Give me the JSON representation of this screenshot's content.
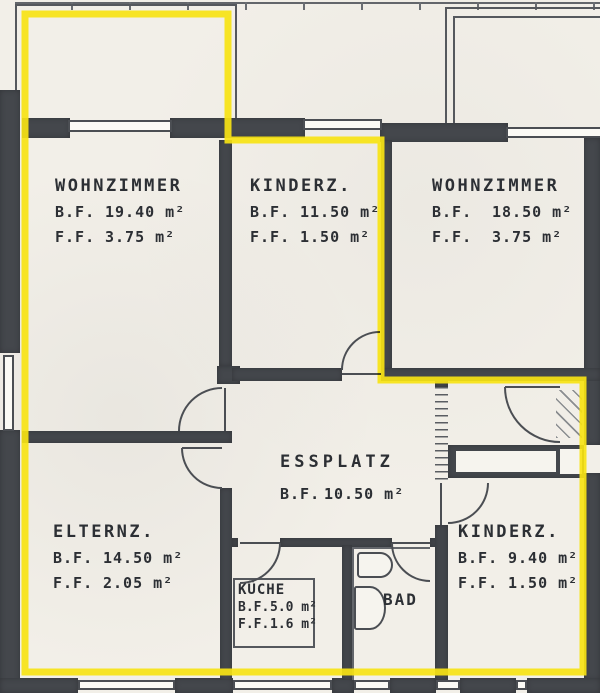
{
  "document_type": "apartment floor plan (scanned)",
  "colors": {
    "highlight_marker": "#f8e313",
    "wall": "#44474c",
    "paper": "#f2efe8",
    "line": "#4b4e53",
    "text": "#2c2f34"
  },
  "rooms": {
    "wohnzimmer_left": {
      "name": "WOHNZIMMER",
      "areas": [
        {
          "k": "B.F.",
          "v": "19.40 m²"
        },
        {
          "k": "F.F.",
          "v": "3.75 m²"
        }
      ]
    },
    "kinderz_mid": {
      "name": "KINDERZ.",
      "areas": [
        {
          "k": "B.F.",
          "v": "11.50 m²"
        },
        {
          "k": "F.F.",
          "v": "1.50 m²"
        }
      ]
    },
    "wohnzimmer_right": {
      "name": "WOHNZIMMER",
      "areas": [
        {
          "k": "B.F.",
          "v": "18.50 m²"
        },
        {
          "k": "F.F.",
          "v": "3.75 m²"
        }
      ]
    },
    "elternz": {
      "name": "ELTERNZ.",
      "areas": [
        {
          "k": "B.F.",
          "v": "14.50 m²"
        },
        {
          "k": "F.F.",
          "v": "2.05 m²"
        }
      ]
    },
    "essplatz": {
      "name": "ESSPLATZ",
      "areas": [
        {
          "k": "B.F.",
          "v": "10.50 m²"
        }
      ]
    },
    "kueche": {
      "name": "KÜCHE",
      "areas": [
        {
          "k": "B.F.",
          "v": "5.0 m²"
        },
        {
          "k": "F.F.",
          "v": "1.6 m²"
        }
      ]
    },
    "bad": {
      "name": "BAD",
      "areas": []
    },
    "kinderz_right": {
      "name": "KINDERZ.",
      "areas": [
        {
          "k": "B.F.",
          "v": "9.40 m²"
        },
        {
          "k": "F.F.",
          "v": "1.50 m²"
        }
      ]
    }
  }
}
